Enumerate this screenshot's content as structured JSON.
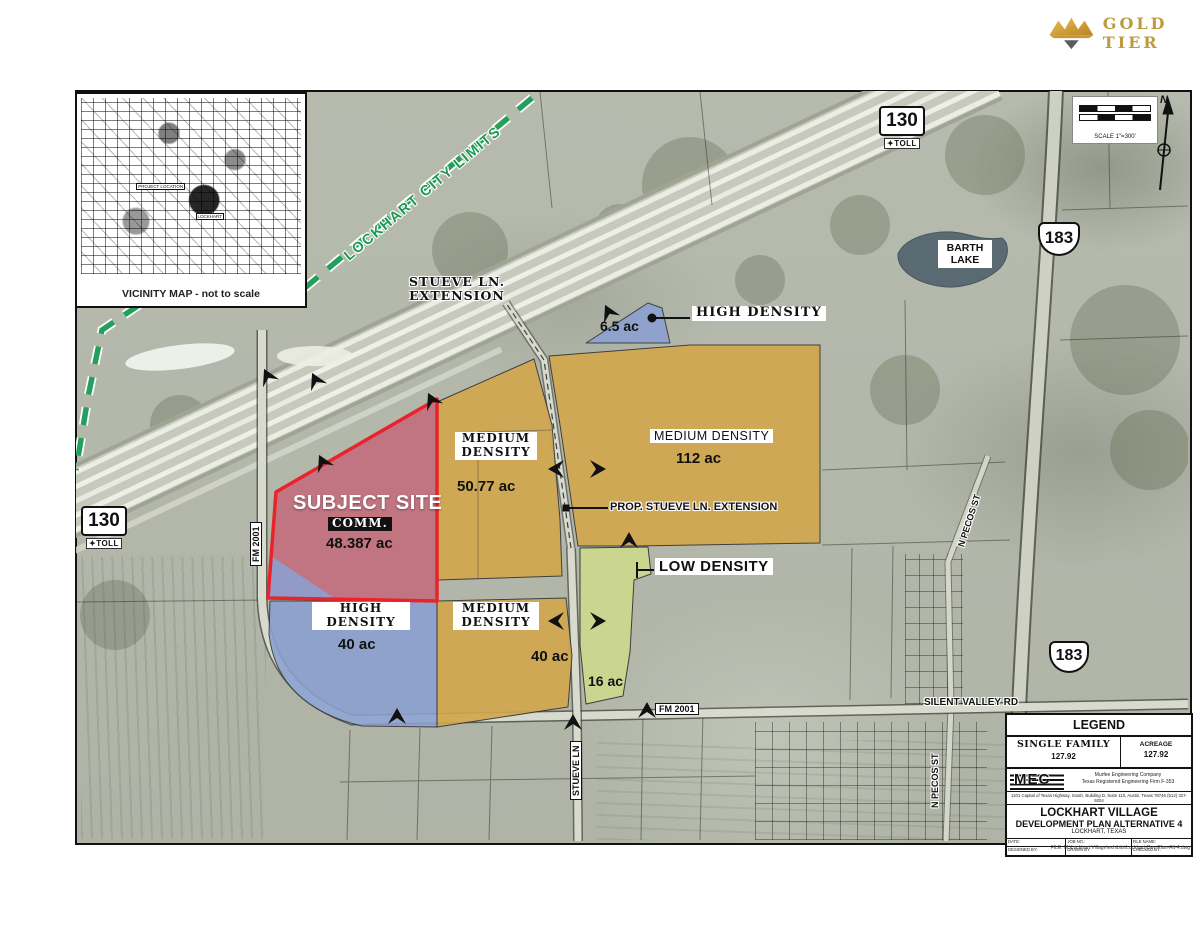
{
  "brand": {
    "text": "GOLD TIER",
    "gold": "#d2a53a",
    "dark": "#565b60"
  },
  "vicinity": {
    "caption": "VICINITY MAP - not to scale",
    "project_location": "PROJECT LOCATION",
    "lockhart": "LOCKHART"
  },
  "scale": {
    "caption": "SCALE 1\"=300'",
    "north": "N"
  },
  "city_limits": "LOCKHART CITY LIMITS",
  "shields": {
    "sh130": "130",
    "toll": "TOLL",
    "us183": "183"
  },
  "roads": {
    "stueve_ext_1": "STUEVE LN.",
    "stueve_ext_2": "EXTENSION",
    "prop_stueve": "PROP. STUEVE LN. EXTENSION",
    "fm2001": "FM 2001",
    "silent_valley": "SILENT VALLEY RD",
    "stueve": "STUEVE LN",
    "pecos": "N PECOS ST"
  },
  "lake": {
    "line1": "BARTH",
    "line2": "LAKE"
  },
  "zones": {
    "hd65": {
      "label": "HIGH DENSITY",
      "acreage": "6.5 ac",
      "color": "#8ba0d2"
    },
    "md112": {
      "label": "MEDIUM DENSITY",
      "acreage": "112 ac",
      "color": "#d2a74b"
    },
    "md5077": {
      "l1": "MEDIUM",
      "l2": "DENSITY",
      "acreage": "50.77 ac",
      "color": "#d2a74b"
    },
    "subject": {
      "title": "SUBJECT SITE",
      "use": "COMM.",
      "acreage": "48.387 ac",
      "fill": "#c3687a",
      "outline": "#e8232b"
    },
    "hd40": {
      "l1": "HIGH",
      "l2": "DENSITY",
      "acreage": "40 ac",
      "color": "#8ba0d2"
    },
    "md40": {
      "l1": "MEDIUM",
      "l2": "DENSITY",
      "acreage": "40 ac",
      "color": "#d2a74b"
    },
    "ld16": {
      "acreage": "16 ac",
      "label": "LOW DENSITY",
      "color": "#cdd88e"
    }
  },
  "titleblock": {
    "legend": "LEGEND",
    "family_hdr": "SINGLE FAMILY",
    "acreage_hdr": "ACREAGE",
    "family_val": "127.92",
    "acreage_val": "127.92",
    "logo": "MEC",
    "firm1": "Murfee Engineering Company",
    "firm2": "Texas Registered Engineering Firm F-353",
    "firm3": "1101 Capital of Texas Highway, South, Building D, Suite 110, Austin, Texas 78746 (512) 327-9204",
    "proj1": "LOCKHART VILLAGE",
    "proj2": "DEVELOPMENT PLAN ALTERNATIVE 4",
    "proj3": "LOCKHART, TEXAS",
    "f_date": "DATE:",
    "f_job": "JOB NO.:",
    "f_file": "FILE NAME:",
    "f_designed": "DESIGNED BY:",
    "f_drawn": "DRAWN BY:",
    "f_checked": "CHECKED BY:",
    "filepath": "FILE: M:\\Lockhart Village\\exhibits\\Lockhart-Dev-Plan-Alt-4.dwg"
  },
  "colors": {
    "aerial": "#b6bbae",
    "city_limits_green": "#23a05a",
    "lake": "#5a6a73",
    "road_fill": "#d8dacd"
  }
}
